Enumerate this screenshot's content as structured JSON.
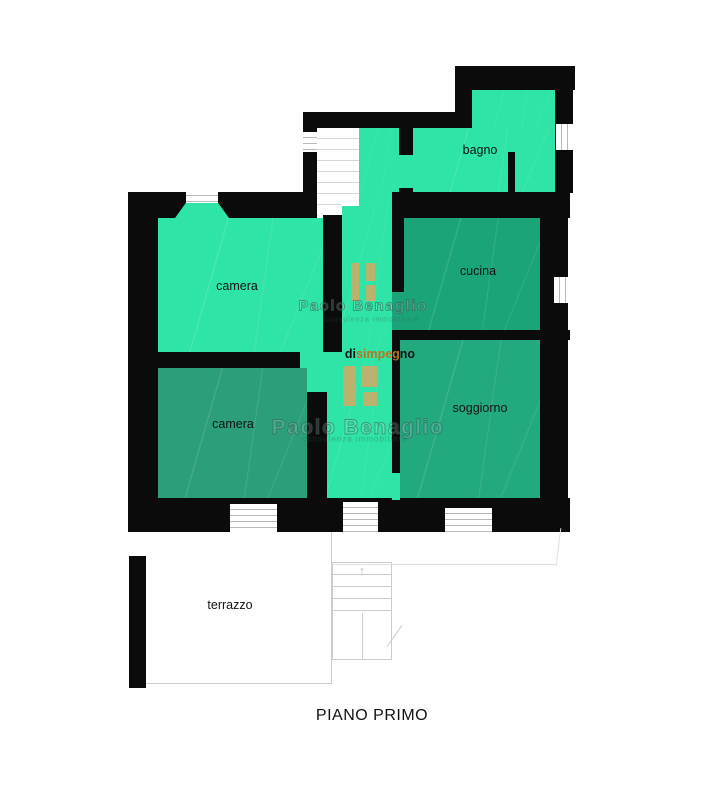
{
  "title": "PIANO PRIMO",
  "watermark": {
    "name": "Paolo Benaglio",
    "tagline": "consulenza immobiliare"
  },
  "rooms": {
    "camera_top": {
      "label": "camera"
    },
    "bagno": {
      "label": "bagno"
    },
    "cucina": {
      "label": "cucina"
    },
    "camera_bottom": {
      "label": "camera"
    },
    "soggiorno": {
      "label": "soggiorno"
    },
    "terrazzo": {
      "label": "terrazzo"
    },
    "disimpegno": {
      "label": "disimpegno",
      "parts": {
        "p1": "di",
        "p2": "simpeg",
        "p3": "no"
      }
    }
  },
  "icons": {
    "stairs_up_arrow": "↑"
  },
  "colors": {
    "room_bright": "#2ee4a6",
    "room_dark_cucina": "#1ba47a",
    "room_dark_soggiorno": "#22a980",
    "room_dark_camera": "#2c9e7b",
    "wall": "#0b0b0b",
    "furniture": "#c9ae6b",
    "label": "#121212",
    "label_accent": "#b5761c"
  }
}
